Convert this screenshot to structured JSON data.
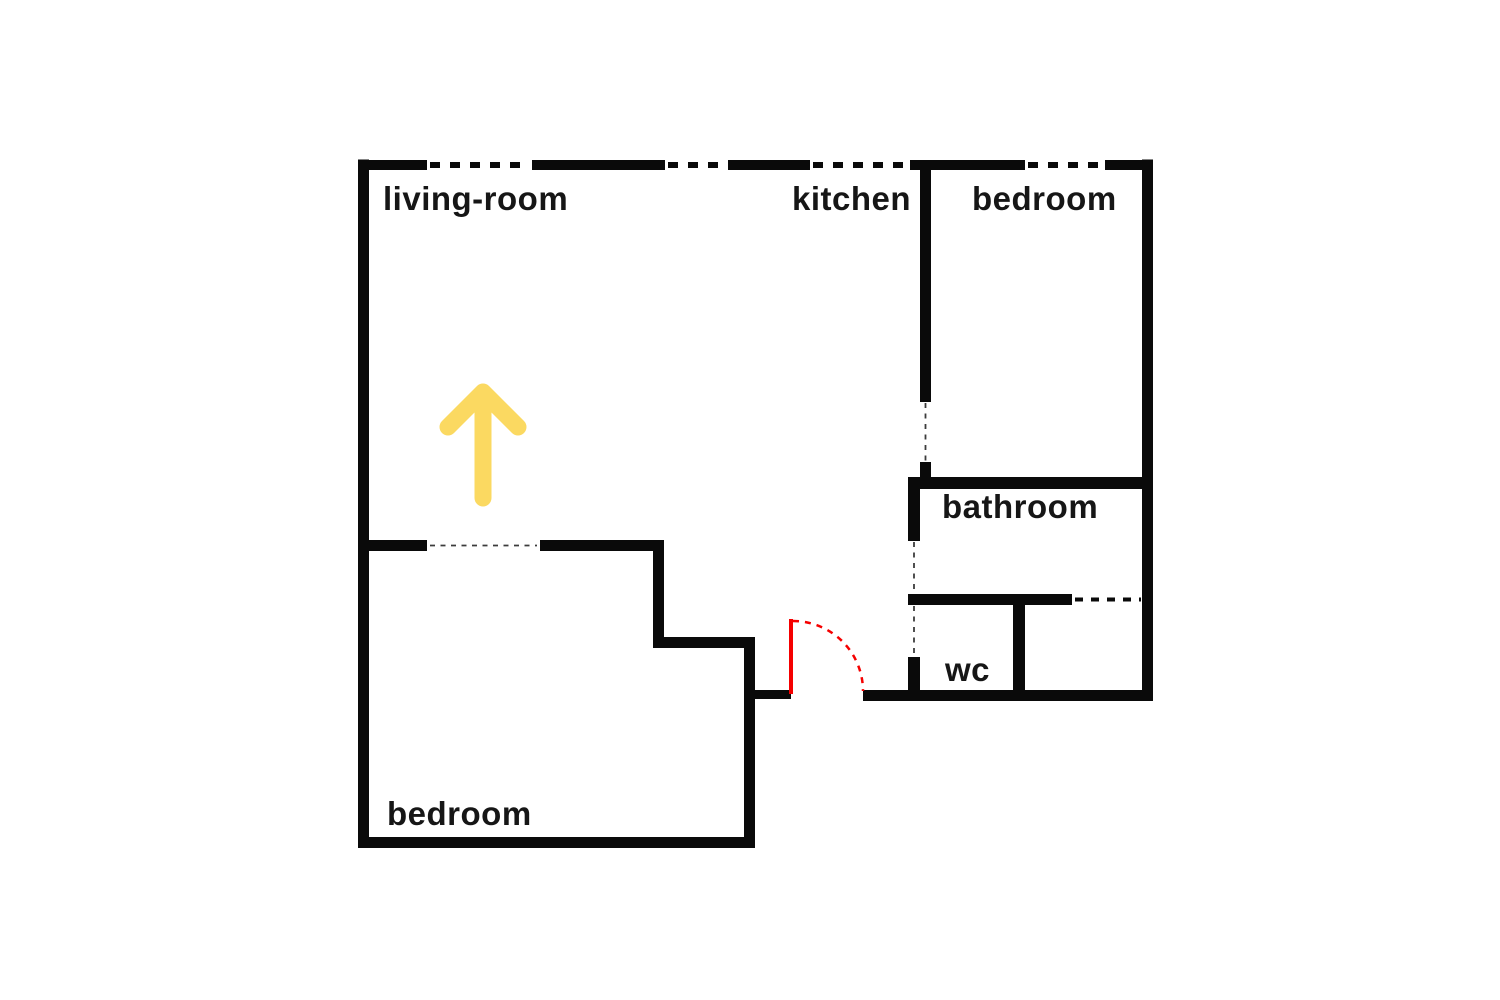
{
  "floor_plan": {
    "rooms": {
      "living_room": {
        "label": "living-room"
      },
      "kitchen": {
        "label": "kitchen"
      },
      "bedroom_top": {
        "label": "bedroom"
      },
      "bathroom": {
        "label": "bathroom"
      },
      "wc": {
        "label": "wc"
      },
      "bedroom_bottom": {
        "label": "bedroom"
      }
    },
    "annotations": {
      "direction_arrow_icon": "up-arrow-icon",
      "entrance_door_marker": "door-swing-arc"
    },
    "colors": {
      "wall": "#0a0a0a",
      "label": "#161616",
      "door": "#f50000",
      "arrow": "#fbd961",
      "bg": "#ffffff"
    }
  }
}
